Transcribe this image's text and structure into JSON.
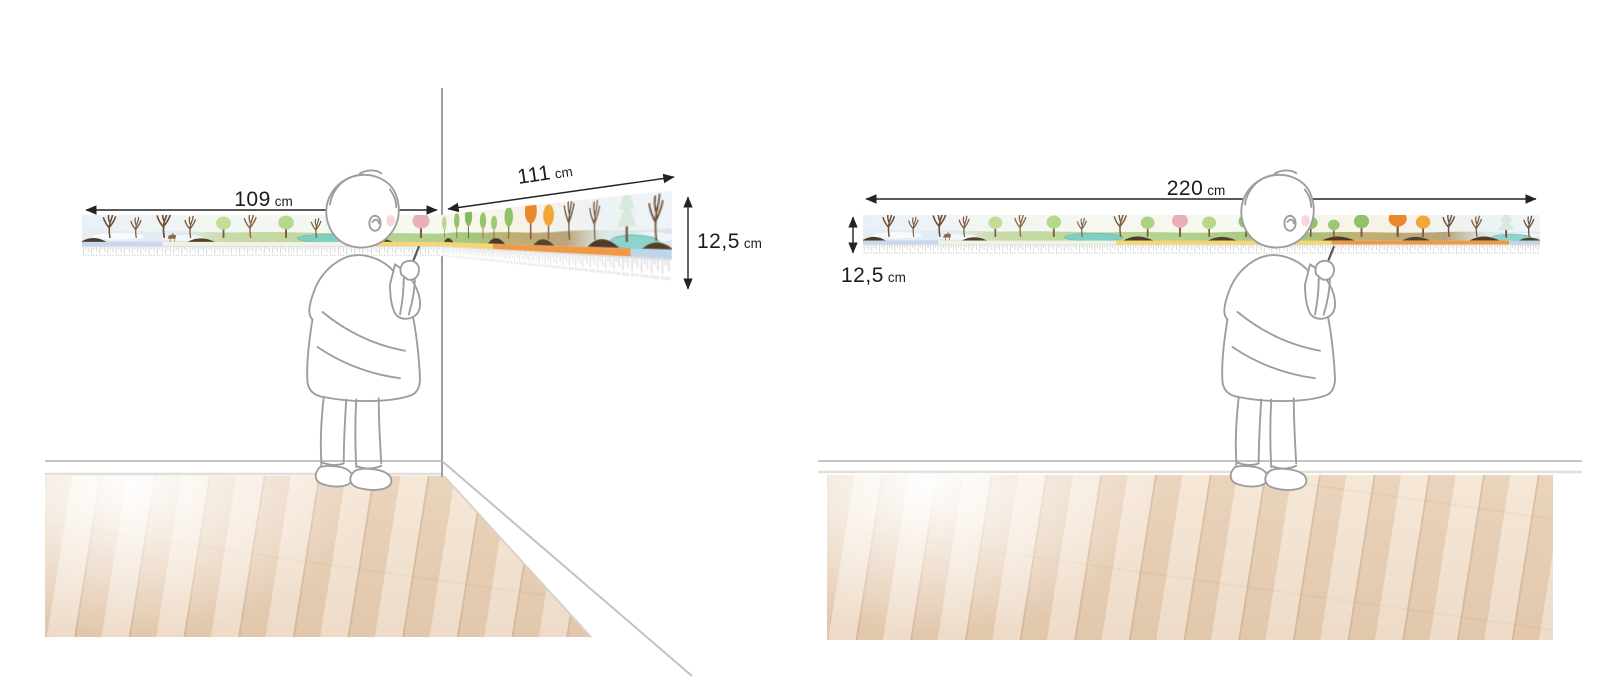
{
  "diagram": {
    "subject": "seasons wall frieze size diagram",
    "panels": {
      "corner": {
        "description": "frieze mounted across a room corner",
        "width_left": {
          "value": "109",
          "unit": "cm"
        },
        "width_right": {
          "value": "111",
          "unit": "cm"
        },
        "height": {
          "value": "12,5",
          "unit": "cm"
        }
      },
      "flat": {
        "description": "frieze mounted on a single flat wall",
        "width": {
          "value": "220",
          "unit": "cm"
        },
        "height": {
          "value": "12,5",
          "unit": "cm"
        }
      }
    }
  },
  "colors": {
    "dimension_line": "#232323",
    "wall_line": "#bdbdbd",
    "floor_base": "#ecd9c6",
    "month_bands": [
      "#c6d9ee",
      "#eff3e4",
      "#f6d76d",
      "#f09944",
      "#bdd6ec"
    ],
    "seasons": {
      "winter": "#e7edf4",
      "spring": "#c8dba6",
      "summer": "#a3c87e",
      "autumn": "#c2a76e",
      "winter_end": "#dce9e6"
    }
  }
}
